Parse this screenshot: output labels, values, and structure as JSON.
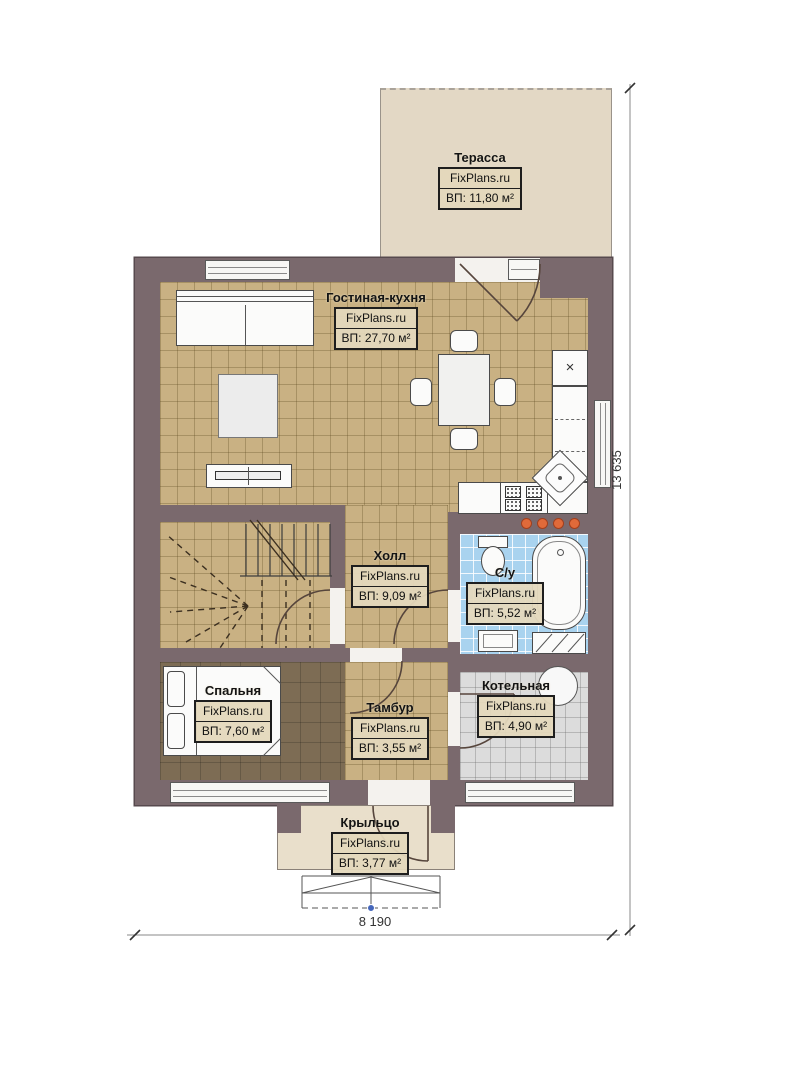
{
  "site": "FixPlans.ru",
  "rooms": [
    {
      "name": "Терасса",
      "area": "ВП: 11,80 м²"
    },
    {
      "name": "Гостиная-кухня",
      "area": "ВП: 27,70 м²"
    },
    {
      "name": "Холл",
      "area": "ВП: 9,09 м²"
    },
    {
      "name": "С/у",
      "area": "ВП: 5,52 м²"
    },
    {
      "name": "Спальня",
      "area": "ВП: 7,60 м²"
    },
    {
      "name": "Тамбур",
      "area": "ВП: 3,55 м²"
    },
    {
      "name": "Котельная",
      "area": "ВП: 4,90 м²"
    },
    {
      "name": "Крыльцо",
      "area": "ВП: 3,77 м²"
    }
  ],
  "dimensions": {
    "width": "8 190",
    "height": "13 635"
  },
  "icons": {
    "fridge_cross": "×"
  },
  "colors": {
    "wall": "#7a696d",
    "floorTan": "#c9b183",
    "floorBlue": "#a9d3ef",
    "floorGray": "#dcdcdc",
    "floorBedroom": "#7d6c54",
    "terrace": "#e3d8c5",
    "porch": "#e9dfcb",
    "accent": "#e06a3a"
  }
}
